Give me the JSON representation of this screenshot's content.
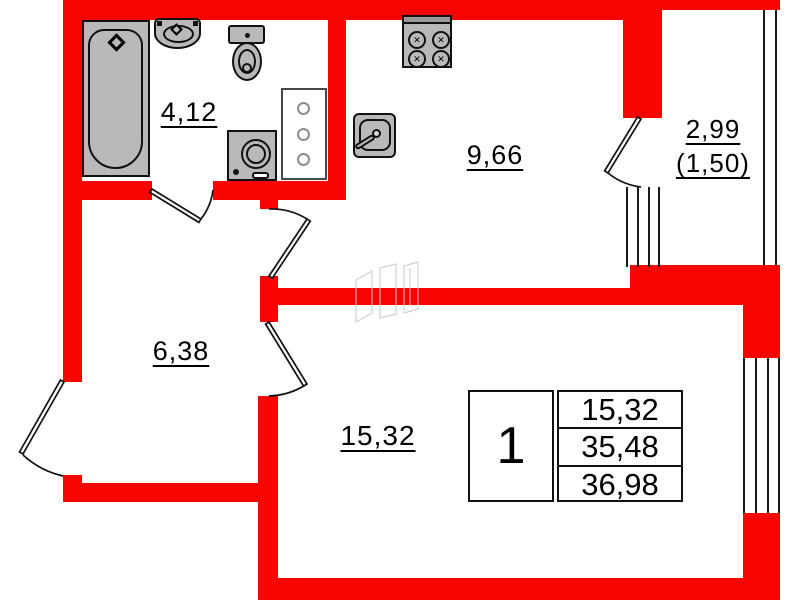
{
  "plan": {
    "type": "apartment-floor-plan",
    "rooms": [
      {
        "id": "bathroom",
        "area_label": "4,12"
      },
      {
        "id": "kitchen",
        "area_label": "9,66"
      },
      {
        "id": "hallway",
        "area_label": "6,38"
      },
      {
        "id": "living-room",
        "area_label": "15,32"
      },
      {
        "id": "balcony",
        "area_label": "2,99",
        "area_label_secondary": "(1,50)"
      }
    ],
    "info_table": {
      "unit_number": "1",
      "rows": [
        "15,32",
        "35,48",
        "36,98"
      ]
    },
    "colors": {
      "wall_red": "#f80400",
      "fixture_gray": "#b9b9b9",
      "outline_black": "#111111"
    }
  }
}
